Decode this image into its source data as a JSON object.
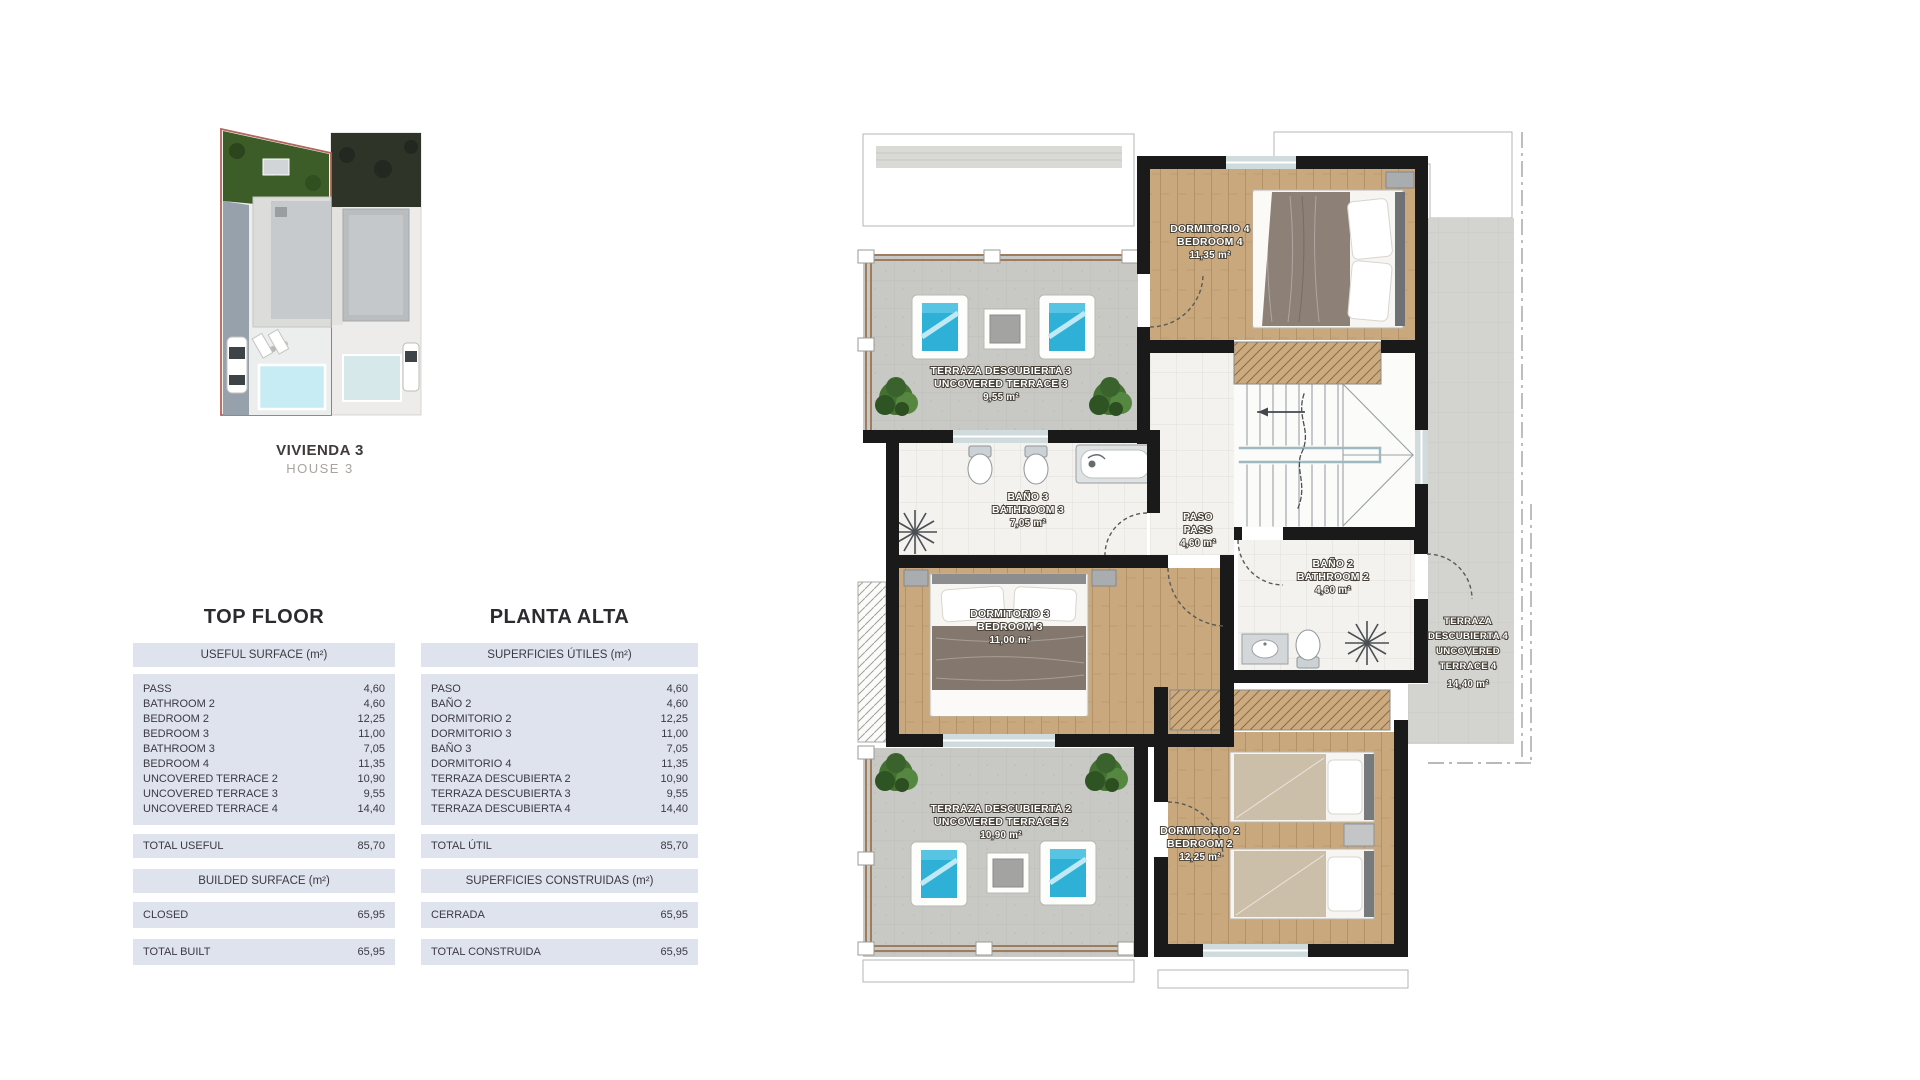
{
  "project": {
    "unit_title": "VIVIENDA 3",
    "unit_subtitle": "HOUSE 3"
  },
  "tables": {
    "english": {
      "title": "TOP FLOOR",
      "useful_header": "USEFUL SURFACE (m²)",
      "rows": [
        {
          "label": "PASS",
          "value": "4,60"
        },
        {
          "label": "BATHROOM 2",
          "value": "4,60"
        },
        {
          "label": "BEDROOM 2",
          "value": "12,25"
        },
        {
          "label": "BEDROOM 3",
          "value": "11,00"
        },
        {
          "label": "BATHROOM 3",
          "value": "7,05"
        },
        {
          "label": "BEDROOM 4",
          "value": "11,35"
        },
        {
          "label": "UNCOVERED TERRACE 2",
          "value": "10,90"
        },
        {
          "label": "UNCOVERED TERRACE 3",
          "value": "9,55"
        },
        {
          "label": "UNCOVERED TERRACE 4",
          "value": "14,40"
        }
      ],
      "total_label": "TOTAL USEFUL",
      "total_value": "85,70",
      "built_header": "BUILDED SURFACE (m²)",
      "closed_label": "CLOSED",
      "closed_value": "65,95",
      "total_built_label": "TOTAL BUILT",
      "total_built_value": "65,95"
    },
    "spanish": {
      "title": "PLANTA ALTA",
      "useful_header": "SUPERFICIES ÚTILES (m²)",
      "rows": [
        {
          "label": "PASO",
          "value": "4,60"
        },
        {
          "label": "BAÑO 2",
          "value": "4,60"
        },
        {
          "label": "DORMITORIO 2",
          "value": "12,25"
        },
        {
          "label": "DORMITORIO 3",
          "value": "11,00"
        },
        {
          "label": "BAÑO 3",
          "value": "7,05"
        },
        {
          "label": "DORMITORIO 4",
          "value": "11,35"
        },
        {
          "label": "TERRAZA DESCUBIERTA 2",
          "value": "10,90"
        },
        {
          "label": "TERRAZA DESCUBIERTA 3",
          "value": "9,55"
        },
        {
          "label": "TERRAZA DESCUBIERTA 4",
          "value": "14,40"
        }
      ],
      "total_label": "TOTAL ÚTIL",
      "total_value": "85,70",
      "built_header": "SUPERFICIES CONSTRUIDAS (m²)",
      "closed_label": "CERRADA",
      "closed_value": "65,95",
      "total_built_label": "TOTAL CONSTRUIDA",
      "total_built_value": "65,95"
    }
  },
  "floorplan": {
    "bedroom4": {
      "es": "DORMITORIO 4",
      "en": "BEDROOM 4",
      "area": "11,35 m²"
    },
    "terrace3": {
      "es": "TERRAZA DESCUBIERTA 3",
      "en": "UNCOVERED TERRACE 3",
      "area": "9,55 m²"
    },
    "bathroom3": {
      "es": "BAÑO 3",
      "en": "BATHROOM 3",
      "area": "7,05 m²"
    },
    "paso": {
      "es": "PASO",
      "en": "PASS",
      "area": "4,60 m²"
    },
    "bathroom2": {
      "es": "BAÑO 2",
      "en": "BATHROOM 2",
      "area": "4,60 m²"
    },
    "terrace4": {
      "l1": "TERRAZA",
      "l2": "DESCUBIERTA 4",
      "l3": "UNCOVERED",
      "l4": "TERRACE 4",
      "area": "14,40 m²"
    },
    "bedroom3": {
      "es": "DORMITORIO 3",
      "en": "BEDROOM 3",
      "area": "11,00 m²"
    },
    "terrace2": {
      "es": "TERRAZA DESCUBIERTA 2",
      "en": "UNCOVERED TERRACE 2",
      "area": "10,90 m²"
    },
    "bedroom2": {
      "es": "DORMITORIO 2",
      "en": "BEDROOM 2",
      "area": "12,25 m²"
    }
  }
}
